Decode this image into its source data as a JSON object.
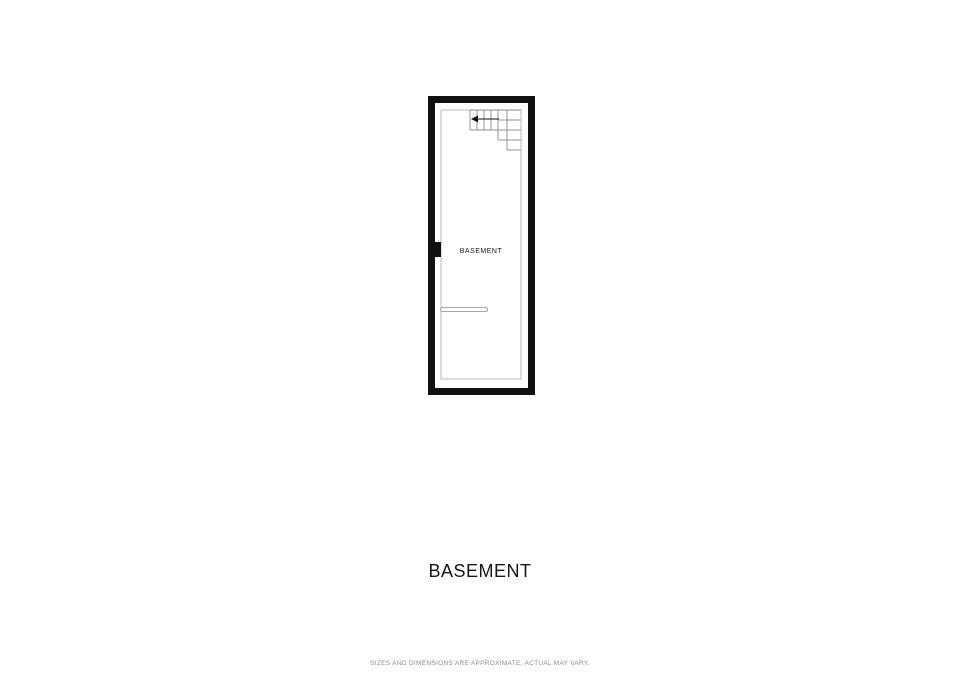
{
  "floorplan": {
    "room_label": "BASEMENT",
    "stairs": {
      "icon": "stair-direction-arrow-icon"
    },
    "colors": {
      "wall": "#111111",
      "inner_line": "#bbbbbb",
      "stair_line": "#969696",
      "background": "#ffffff"
    }
  },
  "title": "BASEMENT",
  "footer": {
    "disclaimer": "SIZES AND DIMENSIONS ARE APPROXIMATE, ACTUAL MAY VARY."
  }
}
